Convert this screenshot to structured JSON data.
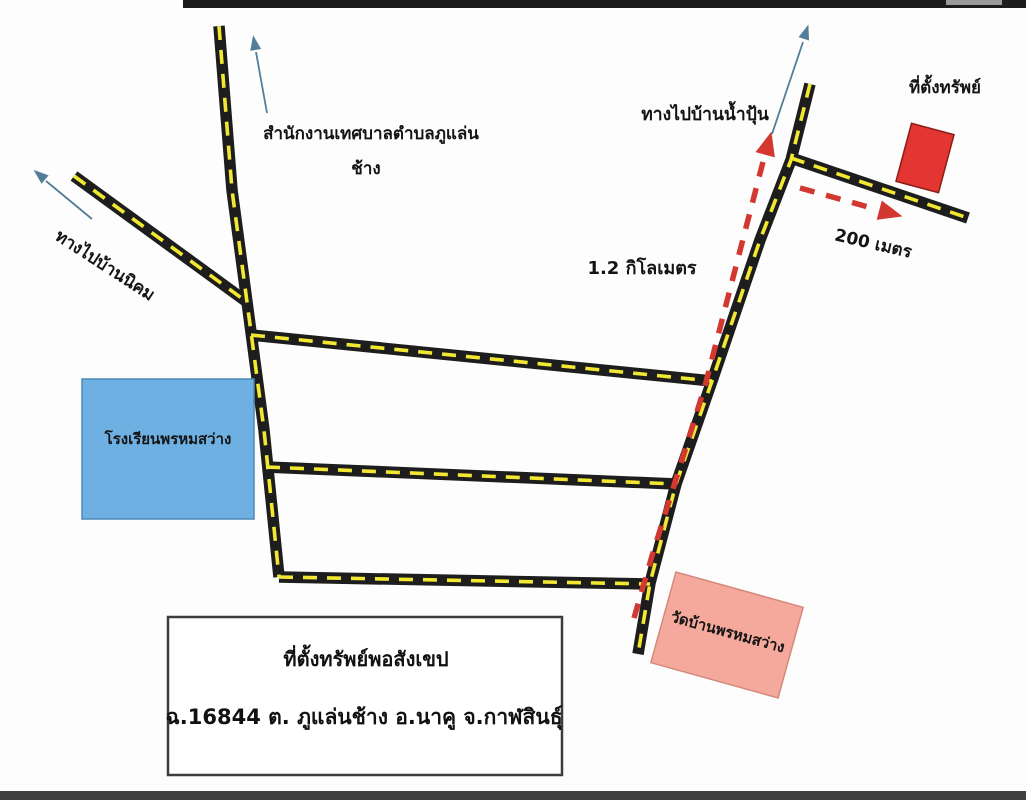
{
  "page": {
    "background": "#fdfdfd",
    "top_scan_bar_color": "#1c1c1c",
    "top_scan_bar_light_patch": "#9a9a9a",
    "bottom_scan_bar_color": "#3f3f3f"
  },
  "colors": {
    "road": "#1d1d1d",
    "road_dash_yellow": "#f2e832",
    "route_red": "#d23730",
    "arrow_blue": "#527e99",
    "school_fill": "#6fb0e3",
    "temple_fill": "#f4a99c",
    "property_fill": "#e33531",
    "text": "#141414"
  },
  "labels": {
    "office_line1": "สำนักงานเทศบาลตำบลภูแล่น",
    "office_line2": "ช้าง",
    "to_ban_nikhom": "ทางไปบ้านนิคม",
    "to_ban_nampun": "ทางไปบ้านน้ำปุ้น",
    "property_site": "ที่ตั้งทรัพย์",
    "distance_200m": "200 เมตร",
    "distance_1_2km": "1.2 กิโลเมตร",
    "school": "โรงเรียนพรหมสว่าง",
    "temple": "วัดบ้านพรหมสว่าง"
  },
  "info_box": {
    "line1": "ที่ตั้งทรัพย์พอสังเขป",
    "line2": "ฉ.16844 ต. ภูแล่นช้าง อ.นาคู จ.กาฬสินธุ์"
  }
}
